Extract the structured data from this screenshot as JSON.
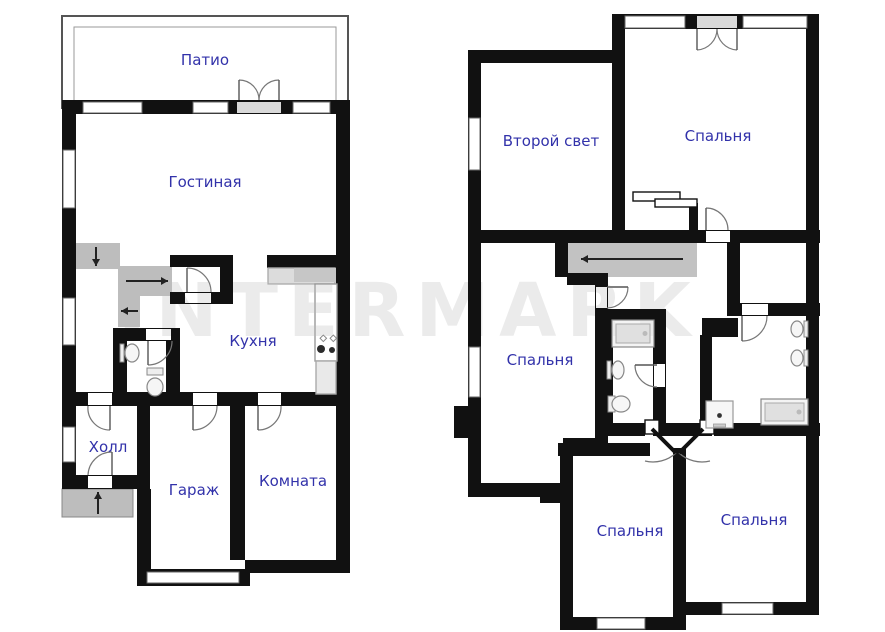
{
  "watermark": {
    "text": "INTERMARK",
    "color": "#ebebeb"
  },
  "palette": {
    "wall": "#111111",
    "label": "#3232aa",
    "stair_gray": "#bdbdbd",
    "corridor_gray": "#c2c2c2",
    "window_stroke": "#666666",
    "door_stroke": "#777777",
    "threshold": "#d9d9d9"
  },
  "floors": [
    {
      "name": "first-floor",
      "outline_rects": [
        {
          "x": 62,
          "y": 16,
          "w": 286,
          "h": 92,
          "stroke": "#555",
          "sw": 2
        },
        {
          "x": 74,
          "y": 27,
          "w": 262,
          "h": 81,
          "stroke": "#999",
          "sw": 1
        }
      ],
      "gray": [
        {
          "x": 72,
          "y": 243,
          "w": 48,
          "h": 26,
          "fill": "#bdbdbd",
          "name": "stair-flight"
        },
        {
          "x": 118,
          "y": 266,
          "w": 54,
          "h": 30,
          "fill": "#bdbdbd",
          "name": "stair-flight"
        },
        {
          "x": 118,
          "y": 296,
          "w": 22,
          "h": 31,
          "fill": "#bdbdbd",
          "name": "stair-flight"
        },
        {
          "x": 62,
          "y": 489,
          "w": 71,
          "h": 28,
          "fill": "#bdbdbd",
          "stroke": "#888",
          "name": "entrance-porch"
        }
      ],
      "walls": [
        [
          62,
          100,
          288,
          14
        ],
        [
          62,
          100,
          14,
          389
        ],
        [
          336,
          100,
          14,
          473
        ],
        [
          267,
          255,
          83,
          13
        ],
        [
          170,
          255,
          63,
          12
        ],
        [
          220,
          267,
          13,
          33
        ],
        [
          170,
          292,
          63,
          12
        ],
        [
          113,
          328,
          14,
          78
        ],
        [
          113,
          328,
          67,
          13
        ],
        [
          166,
          328,
          14,
          78
        ],
        [
          62,
          392,
          288,
          14
        ],
        [
          137,
          406,
          13,
          83
        ],
        [
          62,
          475,
          88,
          14
        ],
        [
          137,
          489,
          14,
          97
        ],
        [
          230,
          406,
          15,
          154
        ],
        [
          245,
          560,
          105,
          13
        ],
        [
          137,
          569,
          113,
          17
        ]
      ],
      "windows": [
        [
          83,
          102,
          59,
          11
        ],
        [
          193,
          102,
          35,
          11
        ],
        [
          293,
          102,
          37,
          11
        ],
        [
          63,
          150,
          12,
          58
        ],
        [
          63,
          298,
          12,
          47
        ],
        [
          63,
          427,
          12,
          35
        ],
        [
          147,
          572,
          92,
          11
        ]
      ],
      "openings": [
        {
          "x": 237,
          "y": 102,
          "w": 44,
          "h": 11,
          "fill": "#d9d9d9"
        },
        {
          "x": 185,
          "y": 293,
          "w": 26,
          "h": 10
        },
        {
          "x": 146,
          "y": 329,
          "w": 25,
          "h": 11
        },
        {
          "x": 88,
          "y": 393,
          "w": 24,
          "h": 12
        },
        {
          "x": 193,
          "y": 393,
          "w": 24,
          "h": 12
        },
        {
          "x": 258,
          "y": 393,
          "w": 23,
          "h": 12
        },
        {
          "x": 88,
          "y": 476,
          "w": 24,
          "h": 12
        }
      ],
      "rects": [
        {
          "x": 268,
          "y": 268,
          "w": 67,
          "h": 16,
          "fill": "#dcdcdc",
          "stroke": "#adadad",
          "name": "kitchen-counter"
        },
        {
          "x": 294,
          "y": 268,
          "w": 41,
          "h": 14,
          "fill": "#c6c6c6",
          "name": "kitchen-sink-counter"
        },
        {
          "x": 315,
          "y": 284,
          "w": 22,
          "h": 77,
          "fill": "#ffffff",
          "stroke": "#999",
          "name": "kitchen-counter"
        },
        {
          "x": 316,
          "y": 361,
          "w": 20,
          "h": 33,
          "fill": "#e9e9e9",
          "stroke": "#aaa",
          "name": "fridge"
        }
      ],
      "doors": [
        {
          "leaf": [
            [
              239,
              100
            ],
            [
              239,
              80
            ]
          ],
          "arc": "M239,80 A20,20 0 0 1 259,100",
          "name": "patio-door"
        },
        {
          "leaf": [
            [
              279,
              100
            ],
            [
              279,
              80
            ]
          ],
          "arc": "M279,80 A20,20 0 0 0 259,100",
          "name": "patio-door"
        },
        {
          "leaf": [
            [
              187,
              292
            ],
            [
              187,
              268
            ]
          ],
          "arc": "M187,268 A24,24 0 0 1 211,292",
          "name": "closet-door"
        },
        {
          "leaf": [
            [
              148,
              341
            ],
            [
              148,
              365
            ]
          ],
          "arc": "M148,365 A24,24 0 0 0 172,341",
          "name": "wc-door"
        },
        {
          "leaf": [
            [
              110,
              406
            ],
            [
              110,
              430
            ]
          ],
          "arc": "M88,406 A22,22 0 0 0 110,430",
          "name": "hall-door"
        },
        {
          "leaf": [
            [
              112,
              475
            ],
            [
              112,
              452
            ]
          ],
          "arc": "M88,475 A24,24 0 0 1 112,452",
          "name": "entrance-door"
        },
        {
          "leaf": [
            [
              193,
              406
            ],
            [
              193,
              430
            ]
          ],
          "arc": "M217,406 A24,24 0 0 1 193,430",
          "name": "garage-door"
        },
        {
          "leaf": [
            [
              258,
              406
            ],
            [
              258,
              430
            ]
          ],
          "arc": "M281,406 A23,23 0 0 1 258,430",
          "name": "room-door"
        }
      ],
      "fixtures": [
        {
          "type": "sink",
          "cx": 132,
          "cy": 353,
          "rx": 7,
          "ry": 9,
          "side": "left"
        },
        {
          "type": "toilet",
          "tank": [
            147,
            368,
            16,
            7
          ],
          "bowl": [
            155,
            387,
            8,
            9
          ]
        },
        {
          "type": "stove",
          "x": 320,
          "y": 333
        }
      ],
      "arrows": [
        [
          96,
          247,
          96,
          266
        ],
        [
          126,
          281,
          168,
          281
        ],
        [
          138,
          311,
          121,
          311
        ],
        [
          98,
          514,
          98,
          492
        ]
      ],
      "labels": [
        {
          "t": "Патио",
          "x": 205,
          "y": 65,
          "name": "label-patio"
        },
        {
          "t": "Гостиная",
          "x": 205,
          "y": 187,
          "name": "label-gostinaya"
        },
        {
          "t": "Кухня",
          "x": 253,
          "y": 346,
          "name": "label-kuhnya"
        },
        {
          "t": "Холл",
          "x": 108,
          "y": 452,
          "name": "label-holl"
        },
        {
          "t": "Гараж",
          "x": 194,
          "y": 495,
          "name": "label-garazh"
        },
        {
          "t": "Комната",
          "x": 293,
          "y": 486,
          "name": "label-komnata"
        }
      ]
    },
    {
      "name": "second-floor",
      "outline_rects": [],
      "gray": [
        {
          "x": 567,
          "y": 243,
          "w": 130,
          "h": 34,
          "fill": "#c2c2c2",
          "name": "stair-landing"
        }
      ],
      "walls": [
        [
          468,
          50,
          150,
          13
        ],
        [
          612,
          14,
          207,
          15
        ],
        [
          468,
          50,
          13,
          447
        ],
        [
          454,
          406,
          14,
          32
        ],
        [
          806,
          14,
          13,
          601
        ],
        [
          612,
          25,
          13,
          218
        ],
        [
          468,
          230,
          352,
          13
        ],
        [
          555,
          243,
          13,
          34
        ],
        [
          567,
          273,
          41,
          12
        ],
        [
          595,
          285,
          13,
          158
        ],
        [
          563,
          438,
          45,
          13
        ],
        [
          468,
          483,
          105,
          14
        ],
        [
          540,
          483,
          28,
          20
        ],
        [
          600,
          309,
          13,
          127
        ],
        [
          600,
          309,
          66,
          13
        ],
        [
          653,
          309,
          13,
          127
        ],
        [
          600,
          423,
          45,
          13
        ],
        [
          659,
          423,
          42,
          13
        ],
        [
          714,
          423,
          106,
          13
        ],
        [
          727,
          241,
          13,
          75
        ],
        [
          727,
          303,
          93,
          13
        ],
        [
          700,
          335,
          12,
          101
        ],
        [
          702,
          318,
          36,
          19
        ],
        [
          560,
          443,
          13,
          187
        ],
        [
          558,
          443,
          92,
          13
        ],
        [
          673,
          448,
          13,
          182
        ],
        [
          560,
          617,
          126,
          13
        ],
        [
          686,
          602,
          133,
          13
        ],
        [
          689,
          203,
          9,
          38
        ]
      ],
      "windows": [
        [
          625,
          16,
          60,
          12
        ],
        [
          743,
          16,
          64,
          12
        ],
        [
          469,
          118,
          11,
          52
        ],
        [
          469,
          347,
          11,
          50
        ],
        [
          597,
          618,
          48,
          11
        ],
        [
          722,
          603,
          51,
          11
        ]
      ],
      "openings": [
        {
          "x": 697,
          "y": 16,
          "w": 40,
          "h": 12,
          "fill": "#d9d9d9"
        },
        {
          "x": 706,
          "y": 231,
          "w": 24,
          "h": 11
        },
        {
          "x": 596,
          "y": 287,
          "w": 11,
          "h": 21
        },
        {
          "x": 654,
          "y": 364,
          "w": 11,
          "h": 23
        },
        {
          "x": 742,
          "y": 304,
          "w": 26,
          "h": 11
        }
      ],
      "rects": [
        {
          "x": 633,
          "y": 192,
          "w": 47,
          "h": 9,
          "fill": "#fff",
          "stroke": "#111",
          "name": "wardrobe"
        },
        {
          "x": 655,
          "y": 199,
          "w": 42,
          "h": 8,
          "fill": "#fff",
          "stroke": "#111",
          "name": "wardrobe"
        },
        {
          "x": 645,
          "y": 420,
          "w": 14,
          "h": 14,
          "fill": "#fff",
          "stroke": "#111",
          "name": "door-jamb"
        },
        {
          "x": 700,
          "y": 420,
          "w": 14,
          "h": 14,
          "fill": "#fff",
          "stroke": "#111",
          "name": "door-jamb"
        }
      ],
      "doors": [
        {
          "leaf": [
            [
              697,
              29
            ],
            [
              697,
              50
            ]
          ],
          "arc": "M717,29 A21,21 0 0 1 697,50",
          "name": "balcony-door"
        },
        {
          "leaf": [
            [
              737,
              29
            ],
            [
              737,
              50
            ]
          ],
          "arc": "M717,29 A21,21 0 0 0 737,50",
          "name": "balcony-door"
        },
        {
          "leaf": [
            [
              706,
              230
            ],
            [
              706,
              208
            ]
          ],
          "arc": "M728,230 A22,22 0 0 0 706,208",
          "name": "bedroom-door"
        },
        {
          "leaf": [
            [
              607,
              287
            ],
            [
              628,
              287
            ]
          ],
          "arc": "M607,308 A21,21 0 0 0 628,287",
          "name": "bedroom-door"
        },
        {
          "leaf": [
            [
              657,
              365
            ],
            [
              635,
              365
            ]
          ],
          "arc": "M657,387 A22,22 0 0 1 635,365",
          "name": "bathroom-door"
        },
        {
          "leaf": [
            [
              742,
              316
            ],
            [
              742,
              341
            ]
          ],
          "arc": "M767,316 A25,25 0 0 1 742,341",
          "name": "bathroom-door"
        },
        {
          "leaf": [
            [
              652,
              429
            ],
            [
              676,
              453
            ]
          ],
          "arc": "M676,453 A34,34 0 0 1 645,461",
          "thick": true,
          "name": "corner-door"
        },
        {
          "leaf": [
            [
              703,
              429
            ],
            [
              679,
              453
            ]
          ],
          "arc": "M679,453 A34,34 0 0 0 710,461",
          "thick": true,
          "name": "corner-door"
        }
      ],
      "fixtures": [
        {
          "type": "tub",
          "x": 612,
          "y": 320,
          "w": 42,
          "h": 27
        },
        {
          "type": "sink",
          "cx": 618,
          "cy": 370,
          "rx": 6,
          "ry": 9,
          "side": "left"
        },
        {
          "type": "toilet",
          "tank": [
            608,
            396,
            7,
            16
          ],
          "bowl": [
            621,
            404,
            9,
            8
          ]
        },
        {
          "type": "sink",
          "cx": 797,
          "cy": 329,
          "rx": 6,
          "ry": 8,
          "side": "right"
        },
        {
          "type": "sink",
          "cx": 797,
          "cy": 358,
          "rx": 6,
          "ry": 8,
          "side": "right"
        },
        {
          "type": "shower",
          "x": 706,
          "y": 401,
          "s": 27
        },
        {
          "type": "tub",
          "x": 761,
          "y": 399,
          "w": 47,
          "h": 26
        }
      ],
      "arrows": [
        [
          683,
          259,
          581,
          259
        ]
      ],
      "labels": [
        {
          "t": "Второй свет",
          "x": 551,
          "y": 146,
          "name": "label-vtoroy-svet"
        },
        {
          "t": "Спальня",
          "x": 718,
          "y": 141,
          "name": "label-spalnya"
        },
        {
          "t": "Спальня",
          "x": 540,
          "y": 365,
          "name": "label-spalnya"
        },
        {
          "t": "Спальня",
          "x": 630,
          "y": 536,
          "name": "label-spalnya"
        },
        {
          "t": "Спальня",
          "x": 754,
          "y": 525,
          "name": "label-spalnya"
        }
      ]
    }
  ]
}
